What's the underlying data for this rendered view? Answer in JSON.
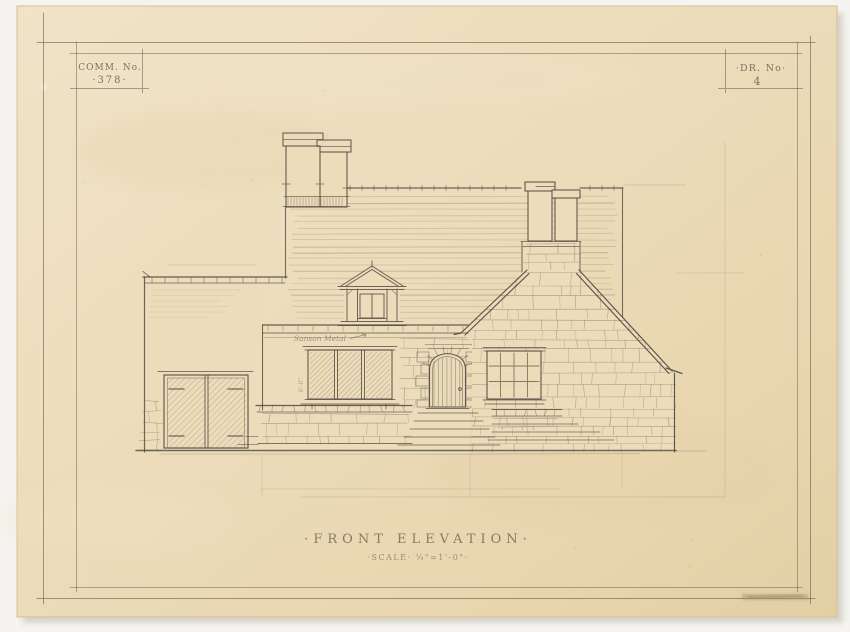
{
  "palette": {
    "background": "#f5f4f1",
    "paper": "#ecdcba",
    "paper_edge": "#d6bf95",
    "pencil": "#564e43",
    "stone": "#6b6156"
  },
  "title_block": {
    "comm_label": "COMM. No.",
    "comm_value": "·378·",
    "dr_label": "·DR. No·",
    "dr_value": "4"
  },
  "caption": {
    "title": "·FRONT ELEVATION·",
    "scale": "·SCALE· ¼\"=1'-0\"·"
  },
  "notes": {
    "material": "Sanson Metal",
    "dimension": "6'-0\""
  }
}
